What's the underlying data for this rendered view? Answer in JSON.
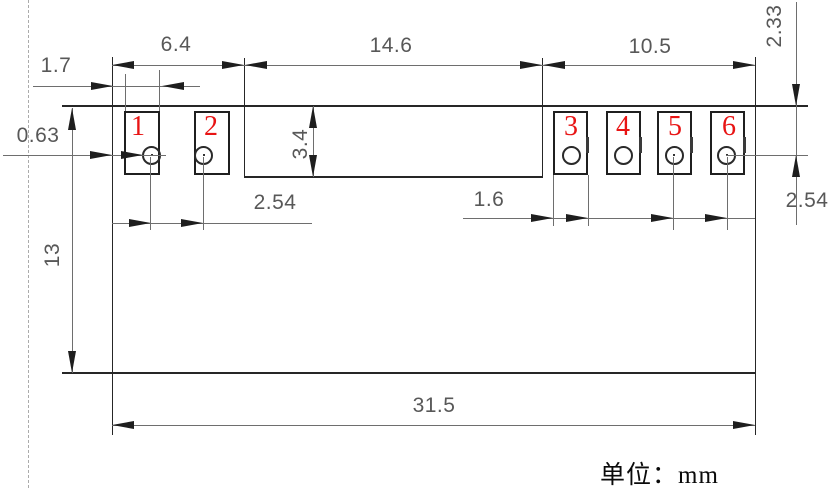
{
  "drawing": {
    "type": "dimensioned mechanical drawing of a 6-pad module",
    "unit_note": "单位：mm"
  },
  "dims": {
    "left_section_width": "6.4",
    "middle_section_width": "14.6",
    "right_section_width": "10.5",
    "left_pad_width": "1.7",
    "left_edge_to_pad": "0.63",
    "body_height": "3.4",
    "board_height": "13",
    "left_hole_pitch": "2.54",
    "right_pad_width": "1.6",
    "right_hole_pitch": "2.54",
    "top_edge_to_hole": "2.33",
    "board_width": "31.5"
  },
  "pads": {
    "p1": "1",
    "p2": "2",
    "p3": "3",
    "p4": "4",
    "p5": "5",
    "p6": "6"
  },
  "colors": {
    "outline": "#262626",
    "dimension_line": "#6e6e6e",
    "dimension_text": "#585858",
    "pad_number": "#e81414",
    "background": "#ffffff"
  }
}
